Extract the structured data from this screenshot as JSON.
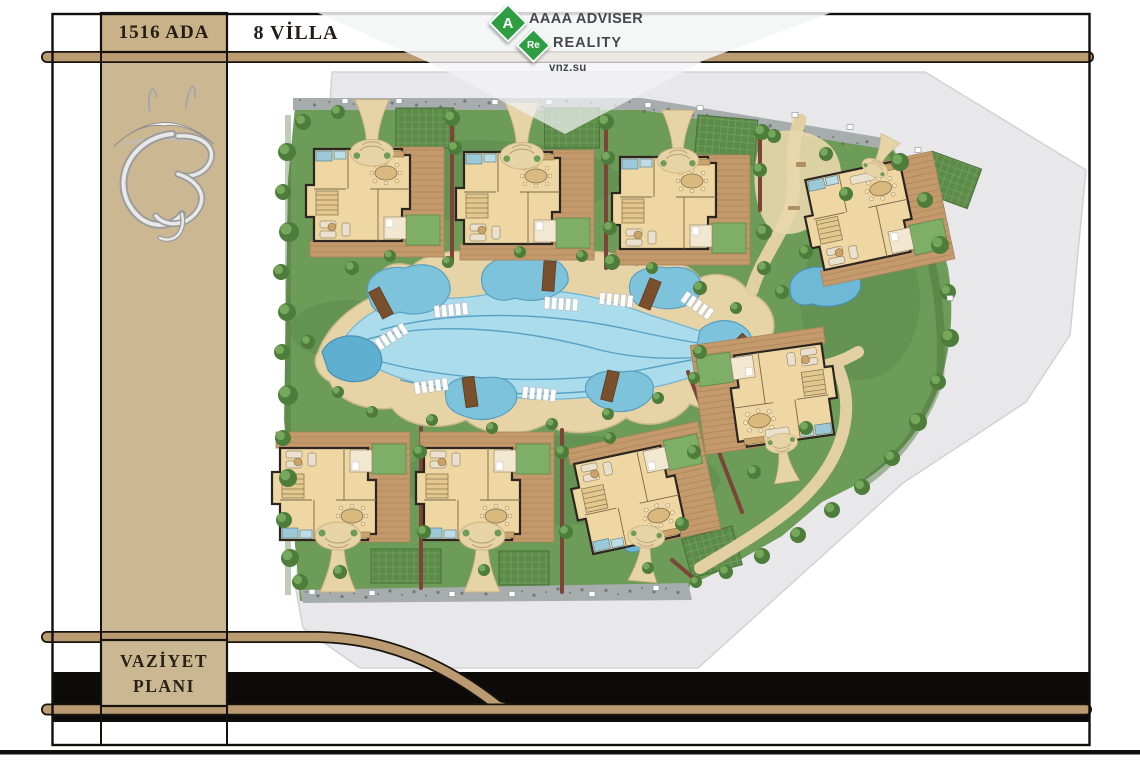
{
  "header": {
    "block_label": "1516 ADA",
    "villa_count_label": "8 VİLLA"
  },
  "footer": {
    "plan_title_line1": "VAZİYET",
    "plan_title_line2": "PLANI"
  },
  "watermark": {
    "badge1": "A",
    "badge2": "Re",
    "line1": "AAAA ADVISER",
    "line2": "REALITY",
    "line3": "vnz.su",
    "badge_color": "#2f9e43",
    "text_color": "#43484c"
  },
  "colors": {
    "frame_black": "#121110",
    "band_tan": "#bb9c72",
    "sidebar_tan": "#cbb893",
    "paper_gray": "#e8e8ea",
    "grass_green": "#6d9b58",
    "pool_light": "#aadcec",
    "pool_deep": "#72bedb",
    "sand_path": "#e6d3a6",
    "deck_wood": "#c49a6d",
    "villa_floor": "#eed7a2",
    "hedge_red": "#7d4438",
    "tree_green": "#4e7c3a",
    "tree_light": "#76a85c",
    "bridge_brown": "#7a4f2c",
    "lounger_white": "#ffffff",
    "gravel_gray": "#a7adad",
    "lawn_panel": "#5c8a48"
  },
  "plan": {
    "villas": [
      {
        "x": 372,
        "y": 197,
        "rot": 0,
        "sx": 1,
        "sy": 1
      },
      {
        "x": 522,
        "y": 200,
        "rot": 0,
        "sx": 1,
        "sy": 1
      },
      {
        "x": 678,
        "y": 205,
        "rot": 0,
        "sx": 1,
        "sy": 1
      },
      {
        "x": 872,
        "y": 215,
        "rot": -12,
        "sx": 1,
        "sy": 1
      },
      {
        "x": 770,
        "y": 395,
        "rot": -8,
        "sx": -1,
        "sy": -1
      },
      {
        "x": 640,
        "y": 495,
        "rot": -12,
        "sx": 1,
        "sy": -1
      },
      {
        "x": 482,
        "y": 492,
        "rot": 0,
        "sx": 1,
        "sy": -1
      },
      {
        "x": 338,
        "y": 492,
        "rot": 0,
        "sx": 1,
        "sy": -1
      }
    ],
    "funnels": [
      [
        372,
        149,
        0,
        0.95
      ],
      [
        522,
        152,
        0,
        0.95
      ],
      [
        678,
        157,
        0,
        0.9
      ],
      [
        876,
        166,
        28,
        0.6
      ],
      [
        782,
        446,
        172,
        0.7
      ],
      [
        646,
        540,
        185,
        0.8
      ],
      [
        482,
        540,
        180,
        1
      ],
      [
        338,
        540,
        180,
        1
      ]
    ],
    "trees": [
      [
        287,
        152,
        9
      ],
      [
        283,
        192,
        8
      ],
      [
        289,
        232,
        10
      ],
      [
        281,
        272,
        8
      ],
      [
        287,
        312,
        9
      ],
      [
        282,
        352,
        8
      ],
      [
        288,
        395,
        10
      ],
      [
        283,
        438,
        8
      ],
      [
        288,
        478,
        9
      ],
      [
        284,
        520,
        8
      ],
      [
        290,
        558,
        9
      ],
      [
        300,
        582,
        8
      ],
      [
        303,
        122,
        8
      ],
      [
        338,
        112,
        7
      ],
      [
        452,
        118,
        8
      ],
      [
        455,
        148,
        7
      ],
      [
        606,
        122,
        8
      ],
      [
        608,
        158,
        7
      ],
      [
        610,
        228,
        7
      ],
      [
        612,
        262,
        8
      ],
      [
        762,
        132,
        8
      ],
      [
        760,
        170,
        7
      ],
      [
        764,
        232,
        8
      ],
      [
        764,
        268,
        7
      ],
      [
        900,
        162,
        9
      ],
      [
        925,
        200,
        8
      ],
      [
        940,
        245,
        9
      ],
      [
        948,
        292,
        8
      ],
      [
        950,
        338,
        9
      ],
      [
        938,
        382,
        8
      ],
      [
        918,
        422,
        9
      ],
      [
        892,
        458,
        8
      ],
      [
        862,
        487,
        8
      ],
      [
        832,
        510,
        8
      ],
      [
        798,
        535,
        8
      ],
      [
        762,
        556,
        8
      ],
      [
        726,
        572,
        7
      ],
      [
        696,
        582,
        6
      ],
      [
        352,
        268,
        7
      ],
      [
        390,
        256,
        6
      ],
      [
        448,
        262,
        6
      ],
      [
        520,
        252,
        6
      ],
      [
        582,
        256,
        6
      ],
      [
        652,
        268,
        6
      ],
      [
        700,
        288,
        7
      ],
      [
        736,
        308,
        6
      ],
      [
        338,
        392,
        6
      ],
      [
        372,
        412,
        6
      ],
      [
        432,
        420,
        6
      ],
      [
        492,
        428,
        6
      ],
      [
        552,
        424,
        6
      ],
      [
        608,
        414,
        6
      ],
      [
        658,
        398,
        6
      ],
      [
        694,
        378,
        6
      ],
      [
        308,
        342,
        7
      ],
      [
        420,
        452,
        7
      ],
      [
        424,
        532,
        7
      ],
      [
        562,
        452,
        7
      ],
      [
        566,
        532,
        7
      ],
      [
        610,
        438,
        6
      ],
      [
        682,
        524,
        7
      ],
      [
        648,
        568,
        6
      ],
      [
        340,
        572,
        7
      ],
      [
        484,
        570,
        6
      ],
      [
        700,
        352,
        7
      ],
      [
        694,
        452,
        7
      ],
      [
        754,
        472,
        7
      ],
      [
        806,
        428,
        7
      ],
      [
        774,
        136,
        7
      ],
      [
        826,
        154,
        7
      ],
      [
        846,
        194,
        7
      ],
      [
        806,
        252,
        7
      ],
      [
        782,
        292,
        7
      ]
    ],
    "hedges": [
      [
        452,
        126,
        452,
        262
      ],
      [
        606,
        128,
        606,
        268
      ],
      [
        760,
        138,
        760,
        210
      ],
      [
        421,
        428,
        421,
        588
      ],
      [
        562,
        430,
        562,
        592
      ],
      [
        688,
        372,
        742,
        512
      ],
      [
        672,
        560,
        698,
        582
      ]
    ],
    "lawn_grids": [
      [
        425,
        128,
        58,
        40,
        0
      ],
      [
        572,
        128,
        55,
        40,
        0
      ],
      [
        726,
        140,
        60,
        45,
        5
      ],
      [
        950,
        180,
        52,
        42,
        20
      ],
      [
        406,
        566,
        70,
        34,
        0
      ],
      [
        524,
        568,
        50,
        34,
        0
      ],
      [
        712,
        552,
        52,
        40,
        -15
      ]
    ],
    "bridges": [
      [
        381,
        303,
        -28
      ],
      [
        549,
        276,
        4
      ],
      [
        650,
        294,
        22
      ],
      [
        470,
        392,
        -8
      ],
      [
        610,
        386,
        14
      ],
      [
        736,
        348,
        45
      ]
    ],
    "loungers": [
      [
        452,
        310,
        -6
      ],
      [
        562,
        304,
        4
      ],
      [
        617,
        300,
        6
      ],
      [
        392,
        336,
        -32
      ],
      [
        432,
        386,
        -8
      ],
      [
        540,
        394,
        6
      ],
      [
        698,
        306,
        35
      ]
    ],
    "gates": [
      [
        345,
        101
      ],
      [
        399,
        101
      ],
      [
        495,
        102
      ],
      [
        549,
        102
      ],
      [
        648,
        105
      ],
      [
        700,
        108
      ],
      [
        795,
        115
      ],
      [
        850,
        127
      ],
      [
        918,
        150
      ],
      [
        950,
        298
      ],
      [
        312,
        592
      ],
      [
        372,
        593
      ],
      [
        452,
        594
      ],
      [
        512,
        594
      ],
      [
        592,
        594
      ],
      [
        656,
        588
      ]
    ]
  }
}
